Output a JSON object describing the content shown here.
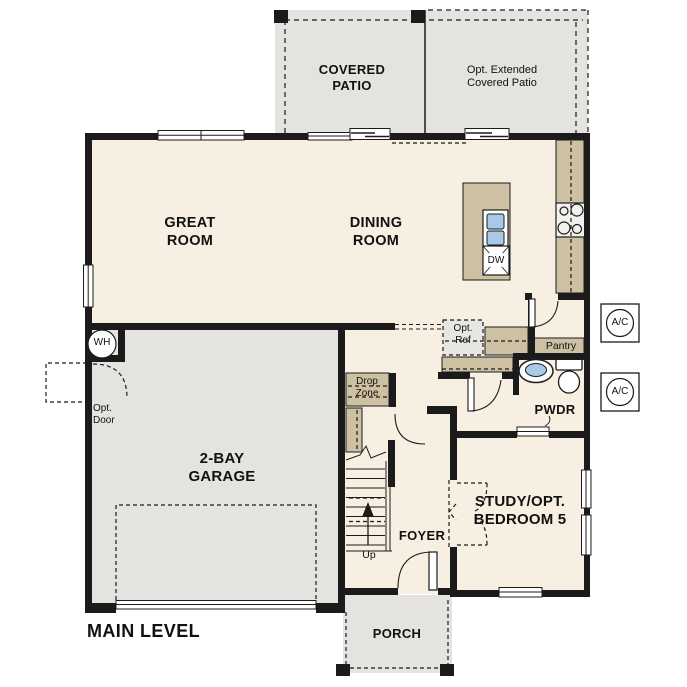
{
  "title": "MAIN LEVEL",
  "rooms": {
    "covered_patio": {
      "line1": "COVERED",
      "line2": "PATIO"
    },
    "opt_extended_patio": {
      "line1": "Opt. Extended",
      "line2": "Covered Patio"
    },
    "great_room": {
      "line1": "GREAT",
      "line2": "ROOM"
    },
    "dining_room": {
      "line1": "DINING",
      "line2": "ROOM"
    },
    "garage": {
      "line1": "2-BAY",
      "line2": "GARAGE"
    },
    "study": {
      "line1": "STUDY/OPT.",
      "line2": "BEDROOM 5"
    },
    "foyer": {
      "label": "FOYER"
    },
    "porch": {
      "label": "PORCH"
    },
    "powder": {
      "label": "PWDR"
    },
    "pantry": {
      "label": "Pantry"
    }
  },
  "annotations": {
    "drop_zone": {
      "line1": "Drop",
      "line2": "Zone"
    },
    "opt_ref": {
      "line1": "Opt.",
      "line2": "Ref"
    },
    "opt_door": {
      "line1": "Opt.",
      "line2": "Door"
    },
    "stairs_up": {
      "label": "Up"
    },
    "dishwasher": {
      "label": "DW"
    },
    "water_heater": {
      "label": "WH"
    },
    "ac_unit": {
      "label": "A/C"
    }
  },
  "colors": {
    "floor_interior": "#f7efe1",
    "outdoor_concrete": "#e4e3e0",
    "counter_tan": "#cec0a3",
    "optional_gray": "#e7e6e3",
    "sink_blue": "#a9c9e9",
    "wall_black": "#1b1b1b"
  }
}
